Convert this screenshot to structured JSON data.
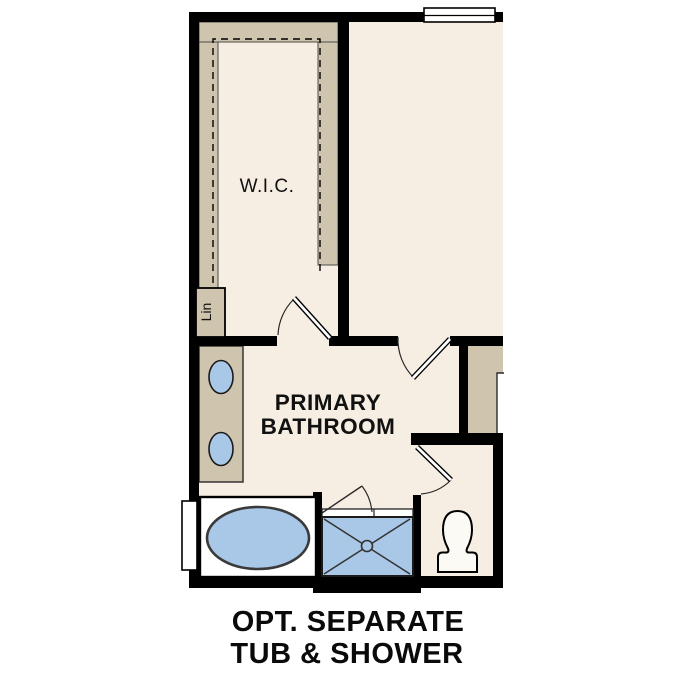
{
  "plan": {
    "labels": {
      "wic": "W.I.C.",
      "linen": "Lin",
      "bathroom_line1": "PRIMARY",
      "bathroom_line2": "BATHROOM"
    },
    "caption": {
      "line1": "OPT. SEPARATE",
      "line2": "TUB & SHOWER"
    },
    "colors": {
      "wall": "#000000",
      "floor": "#F6EEE3",
      "casework": "#CFC5AE",
      "fixture_blue": "#A9C7E6",
      "fixture_white": "#FCFAF5",
      "page": "#FFFFFF"
    }
  }
}
